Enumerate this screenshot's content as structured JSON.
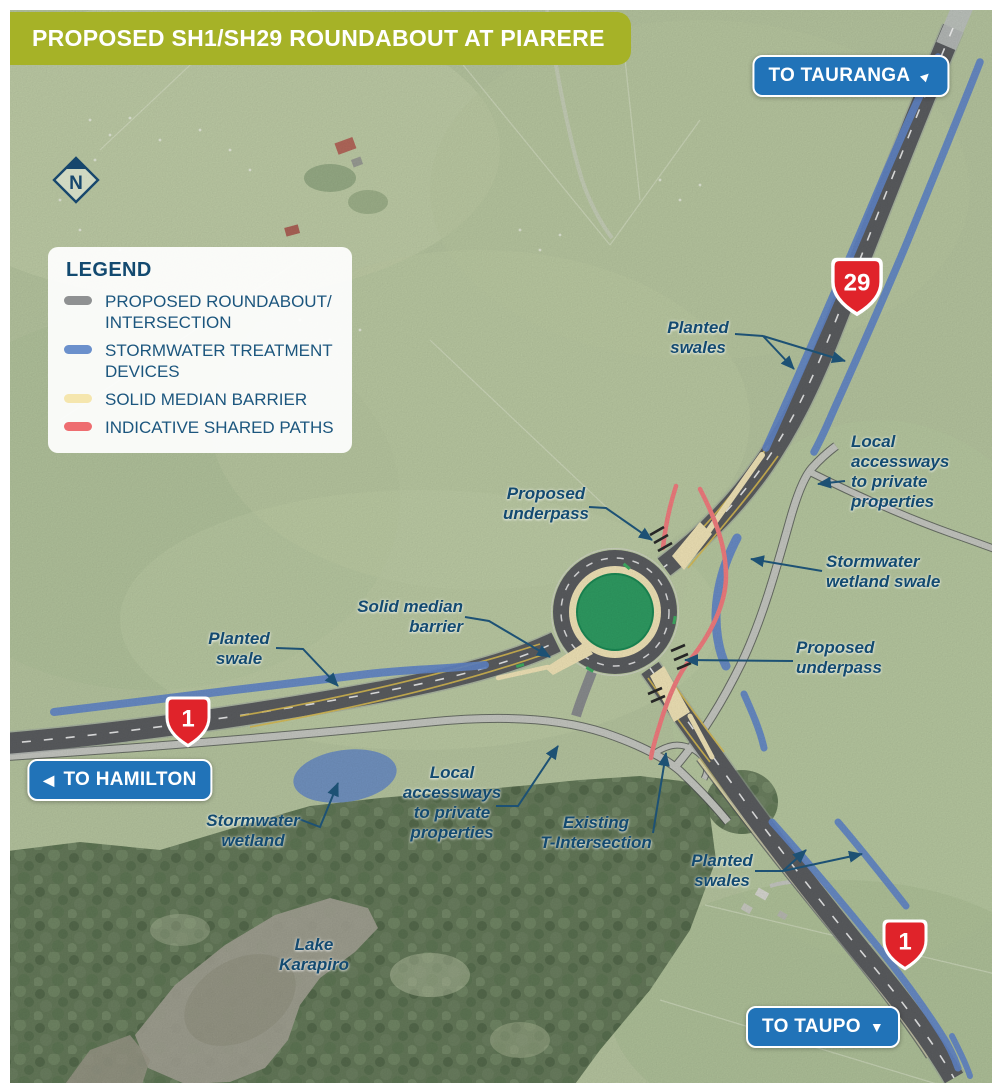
{
  "header": {
    "title": "PROPOSED SH1/SH29 ROUNDABOUT AT PIARERE"
  },
  "compass": {
    "label": "N"
  },
  "legend": {
    "title": "LEGEND",
    "items": [
      {
        "label": "PROPOSED ROUNDABOUT/\nINTERSECTION",
        "color": "#8f9192"
      },
      {
        "label": "STORMWATER TREATMENT\nDEVICES",
        "color": "#6b90cc"
      },
      {
        "label": "SOLID MEDIAN BARRIER",
        "color": "#f5e6ae"
      },
      {
        "label": "INDICATIVE SHARED PATHS",
        "color": "#ee6d70"
      }
    ]
  },
  "direction_badges": {
    "tauranga": {
      "label": "TO TAURANGA",
      "arrow_icon": "▲"
    },
    "hamilton": {
      "label": "TO HAMILTON",
      "arrow_icon": "◀"
    },
    "taupo": {
      "label": "TO TAUPO",
      "arrow_icon": "▼"
    }
  },
  "highway_shields": {
    "sh29": "29",
    "sh1_west": "1",
    "sh1_south": "1"
  },
  "map_labels": {
    "planted_swales_ne": "Planted\nswales",
    "local_accessways_e": "Local\naccessways\nto private\nproperties",
    "stormwater_wetland_swale": "Stormwater\nwetland swale",
    "proposed_underpass_n": "Proposed\nunderpass",
    "proposed_underpass_e": "Proposed\nunderpass",
    "solid_median_barrier": "Solid median\nbarrier",
    "planted_swale_w": "Planted\nswale",
    "stormwater_wetland": "Stormwater\nwetland",
    "local_accessways_s": "Local\naccessways\nto private\nproperties",
    "existing_t_intersection": "Existing\nT-Intersection",
    "planted_swales_s": "Planted\nswales",
    "lake_karapiro": "Lake\nKarapiro"
  },
  "colors": {
    "header_green": "#a6b227",
    "badge_blue": "#2173b8",
    "label_blue": "#134a70",
    "shield_red": "#e0232a",
    "swale_blue": "#6287c9",
    "road_gray": "#5b5d60",
    "median_cream": "#f2e5b8",
    "shared_path_red": "#f27d7f",
    "roundabout_green": "#2f9d63"
  }
}
